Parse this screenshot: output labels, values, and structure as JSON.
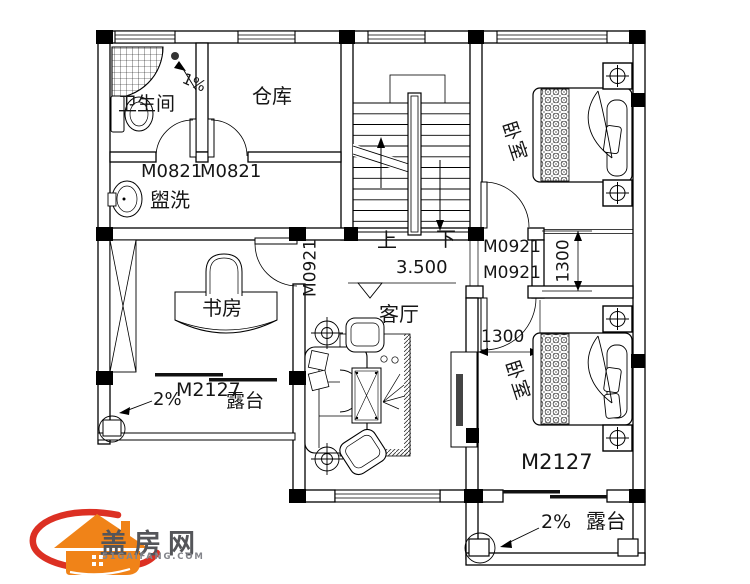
{
  "drawing": {
    "rooms": {
      "bathroom": "卫生间",
      "storage": "仓库",
      "bedroom_top": "卧室",
      "bedroom_bottom": "卧室",
      "laundry": "盥洗",
      "study": "书房",
      "living_room": "客厅",
      "terrace_left": "露台",
      "terrace_right": "露台"
    },
    "doors": {
      "bath": "M0821",
      "storage": "M0821",
      "study": "M0921",
      "bedroom_top": "M0921",
      "bedroom_bottom": "M0921",
      "study_terrace": "M2127",
      "bedroom_terrace": "M2127"
    },
    "stairs": {
      "up": "上",
      "down": "下"
    },
    "annotations": {
      "floor_level": "3.500",
      "bath_slope": "1%",
      "terrace_left_slope": "2%",
      "terrace_right_slope": "2%",
      "dim_bedroom_recess": "1300",
      "dim_bedroom_entry": "1300"
    }
  },
  "logo": {
    "brand": "盖房网",
    "site": "51GAIFANG.COM"
  },
  "colors": {
    "line": "#000000",
    "logo_orange": "#F08318",
    "logo_red": "#DC3023",
    "logo_text": "#545559"
  }
}
